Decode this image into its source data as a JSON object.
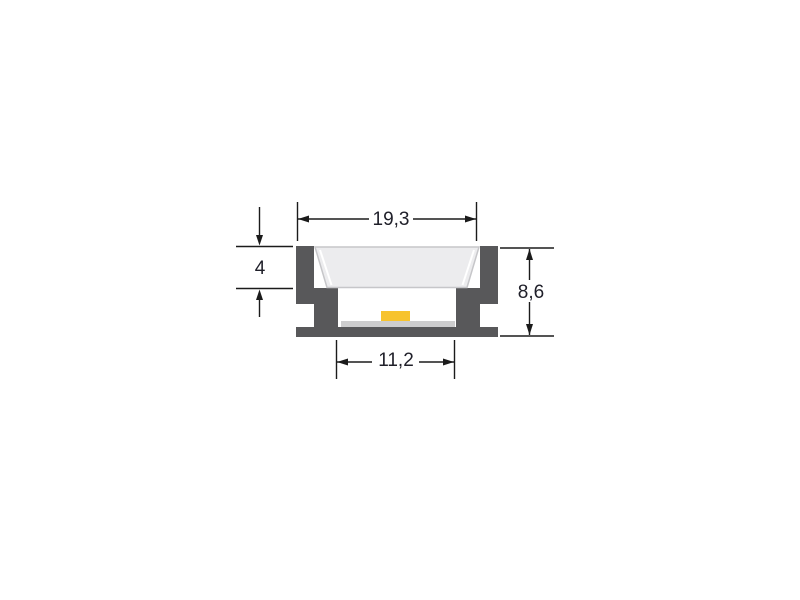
{
  "drawing": {
    "kind": "technical-cross-section",
    "dimensions": {
      "overall_width": {
        "label": "19,3"
      },
      "recess_depth": {
        "label": "4"
      },
      "overall_height": {
        "label": "8,6"
      },
      "inner_width": {
        "label": "11,2"
      }
    },
    "colors": {
      "background": "#ffffff",
      "profile_body": "#58585a",
      "diffuser_fill": "#ececee",
      "diffuser_edge": "#c6c6c9",
      "pcb": "#cdcdce",
      "led": "#f7c32e",
      "dimension_line": "#1b1b1b",
      "dimension_text": "#20202a"
    }
  }
}
